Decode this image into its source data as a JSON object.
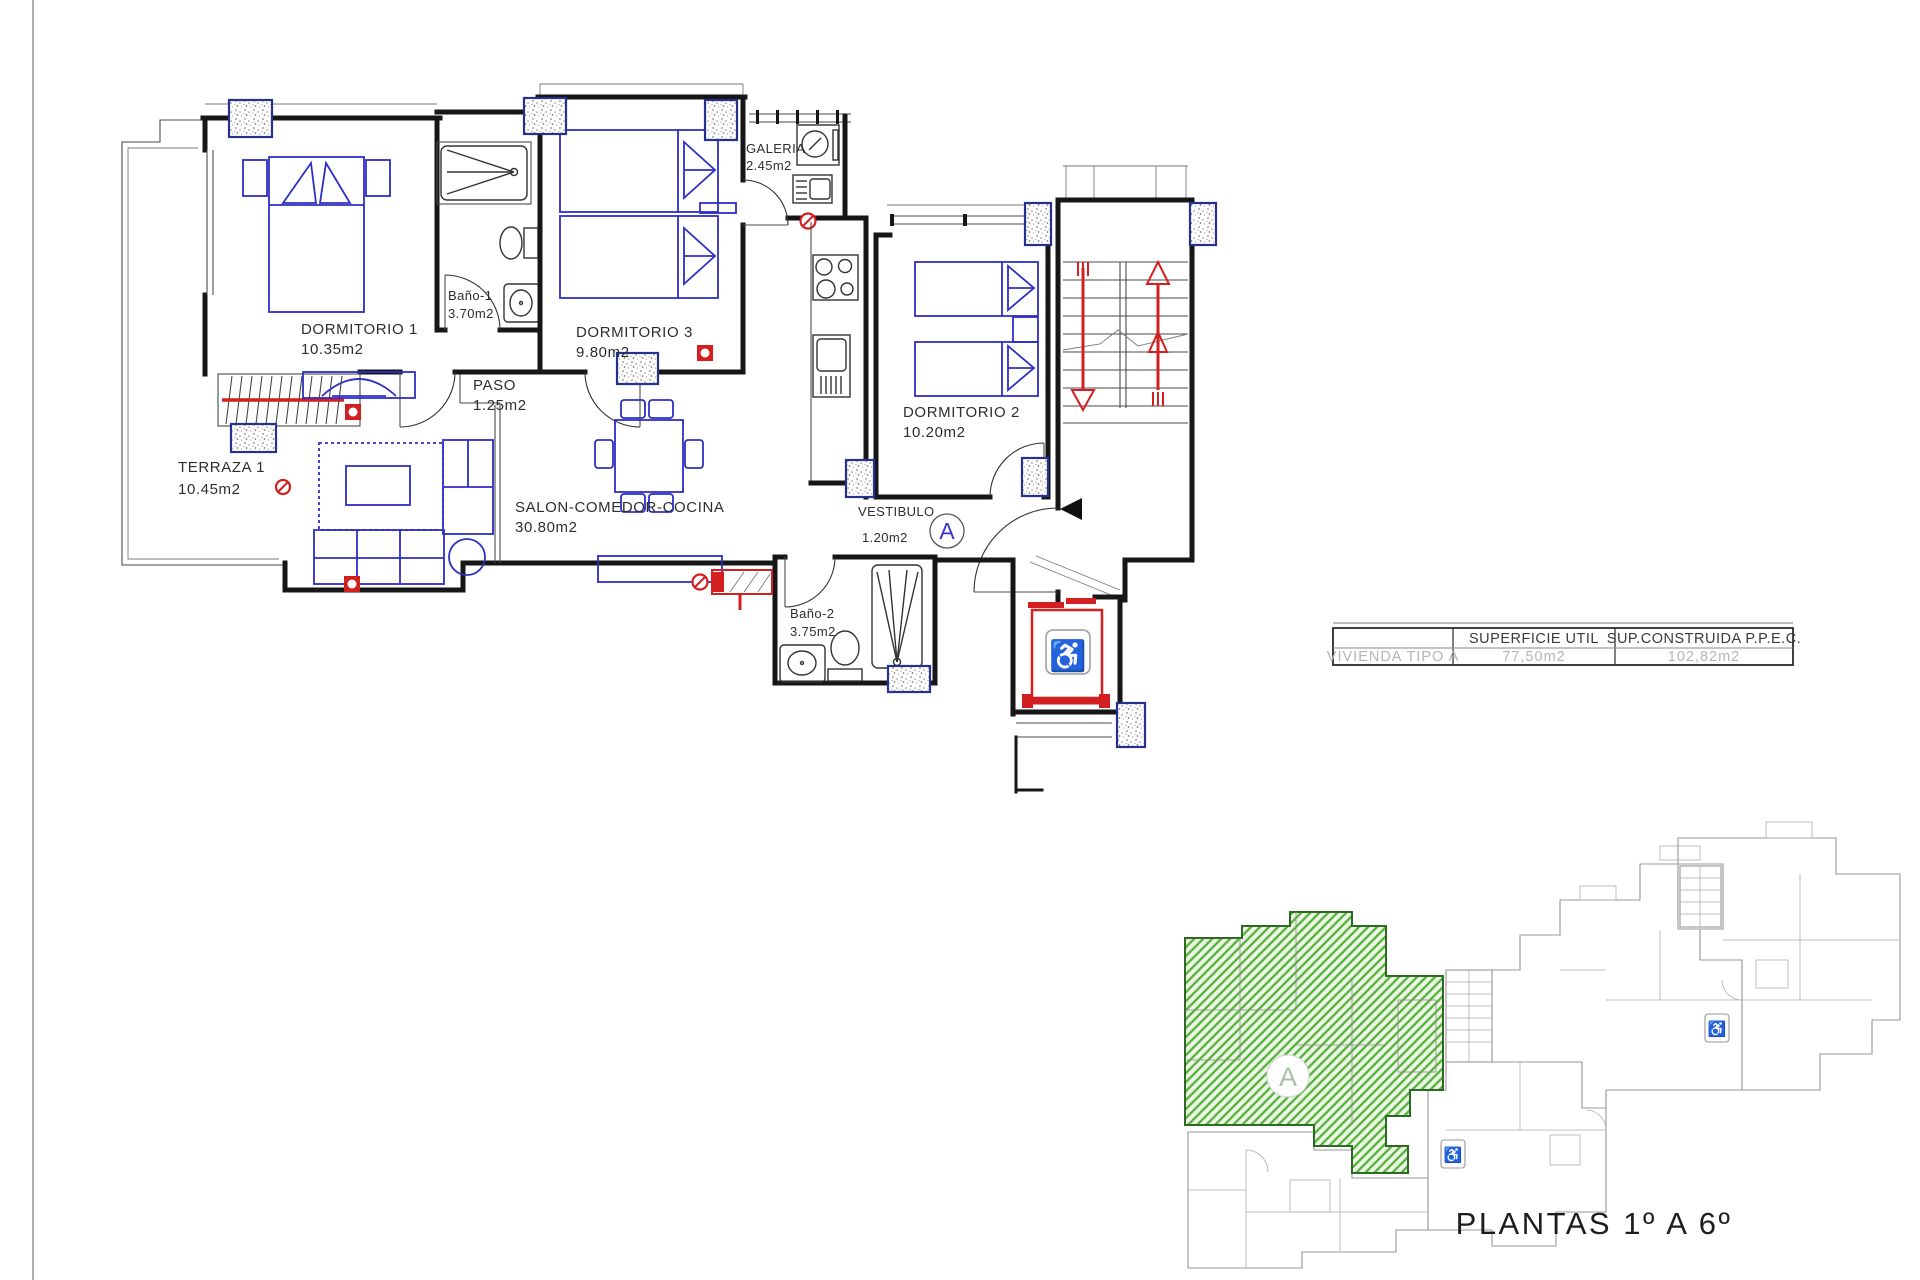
{
  "plan": {
    "rooms": [
      {
        "name": "DORMITORIO 1",
        "area": "10.35m2"
      },
      {
        "name": "Baño-1",
        "area": "3.70m2"
      },
      {
        "name": "DORMITORIO 3",
        "area": "9.80m2"
      },
      {
        "name": "GALERIA",
        "area": "2.45m2"
      },
      {
        "name": "PASO",
        "area": "1.25m2"
      },
      {
        "name": "TERRAZA 1",
        "area": "10.45m2"
      },
      {
        "name": "SALON-COMEDOR-COCINA",
        "area": "30.80m2"
      },
      {
        "name": "DORMITORIO 2",
        "area": "10.20m2"
      },
      {
        "name": "VESTIBULO",
        "area": "1.20m2"
      },
      {
        "name": "Baño-2",
        "area": "3.75m2"
      }
    ],
    "unit_marker": "A",
    "accessibility_icon": "♿"
  },
  "area_table": {
    "header": {
      "superficie": "SUPERFICIE UTIL",
      "construida": "SUP.CONSTRUIDA P.P.E.C."
    },
    "row": {
      "label": "VIVIENDA TIPO A",
      "superficie": "77,50m2",
      "construida": "102,82m2"
    }
  },
  "overview": {
    "caption": "PLANTAS 1º A 6º",
    "unit_marker": "A"
  },
  "colors": {
    "furniture_blue": "#2e2ec4",
    "alert_red": "#d31f1f",
    "highlight_green": "#5cb544",
    "wall_black": "#161616",
    "overview_gray": "#989898"
  }
}
